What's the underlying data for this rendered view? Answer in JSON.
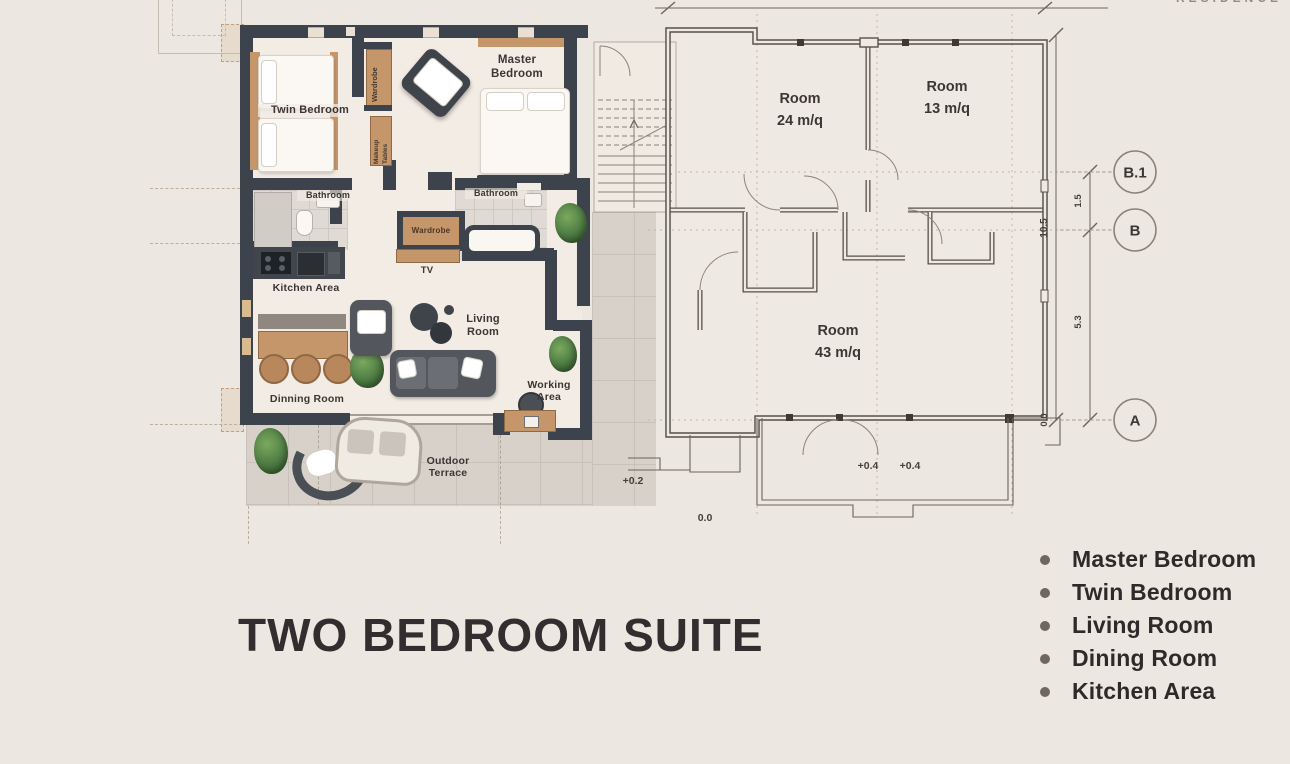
{
  "header": {
    "brand_cropped": "RESIDENCE"
  },
  "title": "TWO BEDROOM SUITE",
  "rendered_plan": {
    "labels": {
      "twin_bedroom": "Twin Bedroom",
      "master_bedroom": "Master Bedroom",
      "wardrobe_top": "Wardrobe",
      "makeup_tables": "Makeup Tables",
      "bathroom_left": "Bathroom",
      "bathroom_right": "Bathroom",
      "wardrobe_mid": "Wardrobe",
      "tv": "TV",
      "kitchen_area": "Kitchen Area",
      "living_room": "Living Room",
      "dinning_room": "Dinning Room",
      "working_area": "Working Area",
      "outdoor_terrace": "Outdoor Terrace"
    }
  },
  "technical_plan": {
    "rooms": [
      {
        "name": "Room",
        "area": "24 m/q"
      },
      {
        "name": "Room",
        "area": "13 m/q"
      },
      {
        "name": "Room",
        "area": "43 m/q"
      }
    ],
    "levels": {
      "terrace_a": "+0.4",
      "terrace_b": "+0.4",
      "entry": "+0.2",
      "ground": "0.0"
    },
    "dimensions": {
      "overall": "10.5",
      "b1_to_b": "1.5",
      "b_to_a": "5.3",
      "datum": "0.0"
    },
    "grid_markers": {
      "b1": "B.1",
      "b": "B",
      "a": "A"
    }
  },
  "legend": {
    "items": [
      {
        "label": "Master Bedroom"
      },
      {
        "label": "Twin Bedroom"
      },
      {
        "label": "Living Room"
      },
      {
        "label": "Dining Room"
      },
      {
        "label": "Kitchen Area"
      }
    ]
  },
  "colors": {
    "background": "#ECE7E1",
    "wall": "#3D434C",
    "wood": "#C6966B",
    "tile": "#D7D1CA",
    "drawing_line": "#57504A",
    "text": "#35302E",
    "plant": "#4E7B43"
  }
}
